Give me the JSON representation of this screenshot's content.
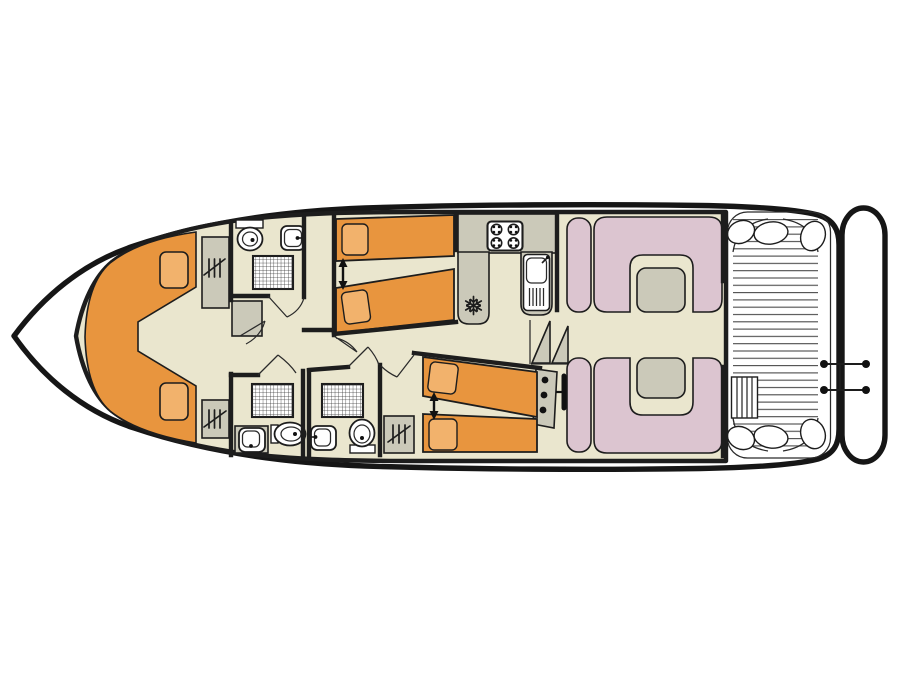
{
  "title": "Houseboat deck plan diagram",
  "colors": {
    "background": "#ffffff",
    "outline": "#1d1d1d",
    "floor": "#eae6ce",
    "bed": "#e8953e",
    "cushion": "#f2b26c",
    "furniture": "#cbc9b9",
    "seating": "#dcc5d0",
    "table": "#cbc9b9",
    "fixture": "#ffffff",
    "deck_line": "#4a4a4a",
    "accent_black": "#111111"
  },
  "inventory": {
    "bow_v_seating_cushions": 2,
    "twin_bed_cabins": 2,
    "bed_join_arrows": 2,
    "wardrobes": 3,
    "storage_cabinets": 2,
    "bathrooms": 3,
    "showers": 3,
    "toilets": 3,
    "washbasins": 3,
    "galley": {
      "hob_burners": 4,
      "sink": 1,
      "fridge": 1
    },
    "saloon": {
      "dinette_benches": 4,
      "tables": 2
    },
    "helm": {
      "instrument_dials": 3,
      "wheel": 1
    },
    "companionway_steps": 2,
    "aft_deck": {
      "boarding_ladder": 1,
      "rail_posts": 4,
      "corner_seats": 6
    },
    "swim_platform": 1
  }
}
